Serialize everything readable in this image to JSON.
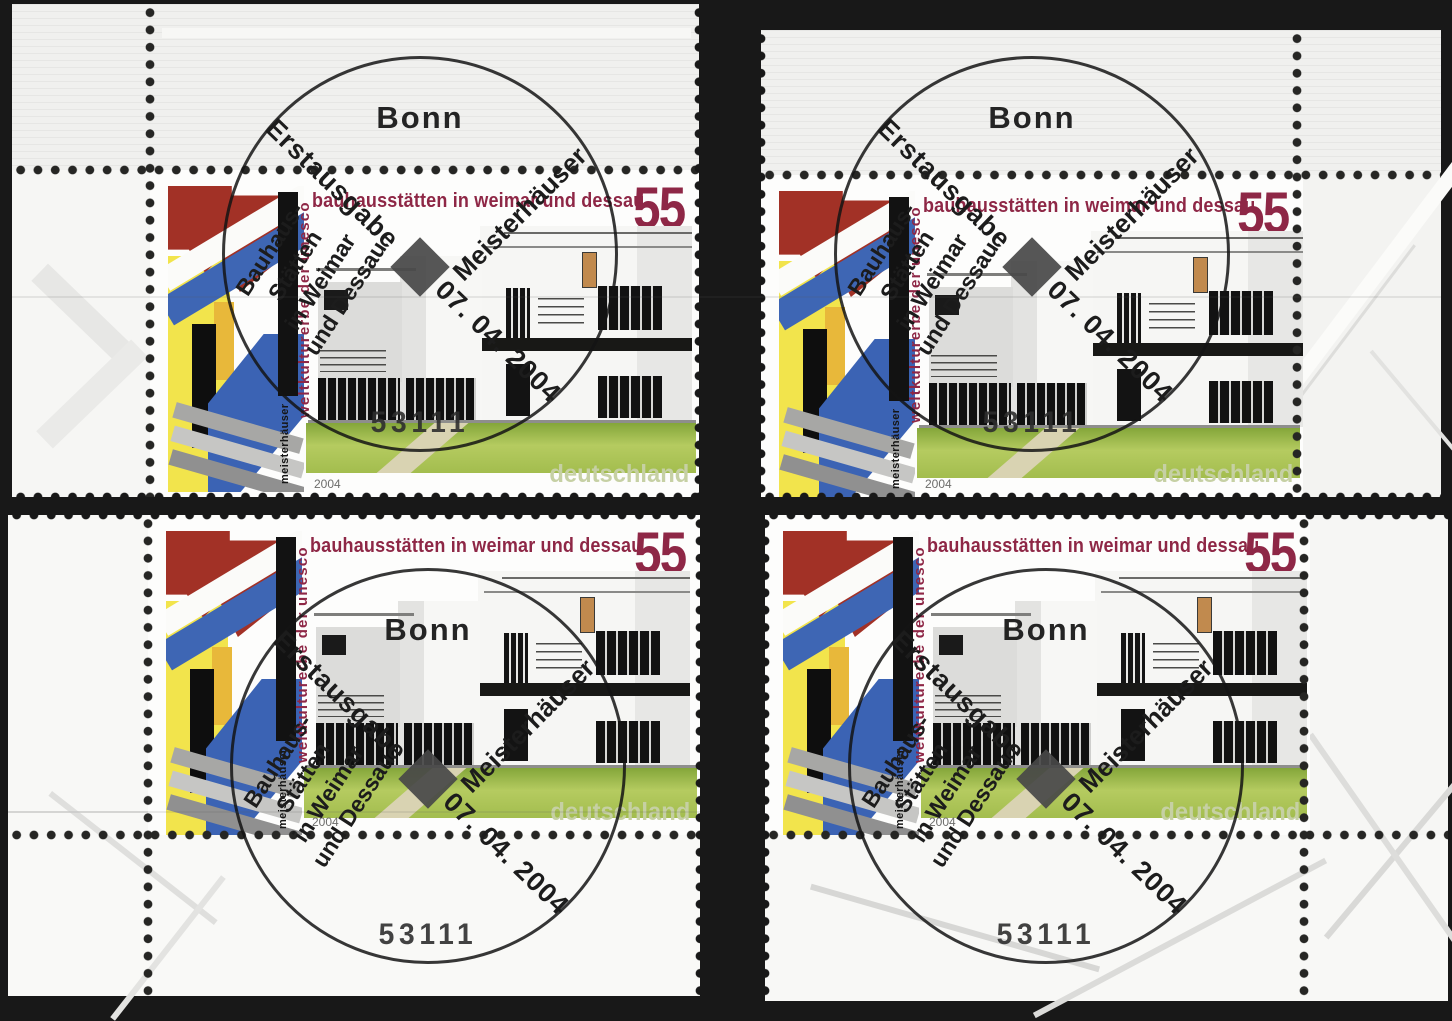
{
  "sheet": {
    "pieces": [
      {
        "corner": "tl",
        "label": "top-left"
      },
      {
        "corner": "tr",
        "label": "top-right"
      },
      {
        "corner": "bl",
        "label": "bottom-left"
      },
      {
        "corner": "br",
        "label": "bottom-right"
      }
    ]
  },
  "stamp": {
    "title": "bauhausstätten in weimar und dessau",
    "denomination": "55",
    "country": "deutschland",
    "year": "2004",
    "side_label_red": "weltkulturerbe der unesco",
    "side_label_black": "meisterhäuser"
  },
  "postmark": {
    "city": "Bonn",
    "first_day_label": "Erstausgabe",
    "occasion_lines": [
      "Bauhaus-",
      "Stätten",
      "in Weimar",
      "und Dessau"
    ],
    "date": "07. 04. 2004",
    "issue_name": "Meisterhäuser",
    "postal_code": "53111"
  },
  "colors": {
    "background": "#181818",
    "crimson": "#8e2746",
    "red": "#a23126",
    "blue": "#3e66b4",
    "yellow": "#f2e44c",
    "lawn": "#b5cb60",
    "country": "#c6d0a4",
    "ink": "#1c1c1c"
  }
}
